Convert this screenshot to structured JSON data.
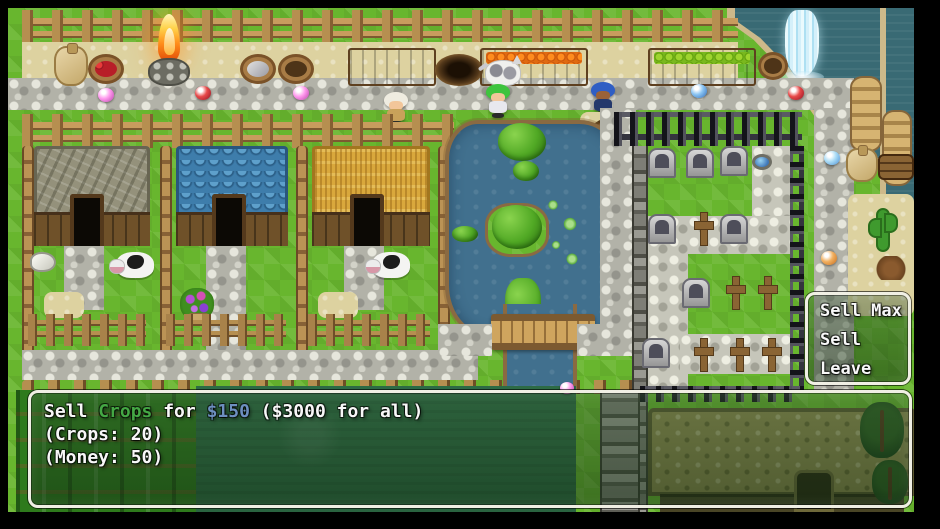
{
  "choice_window": {
    "items": [
      {
        "id": "sell-max",
        "label": "Sell Max"
      },
      {
        "id": "sell",
        "label": "Sell"
      },
      {
        "id": "leave",
        "label": "Leave"
      }
    ]
  },
  "dialog": {
    "line1_prefix": "Sell ",
    "line1_item": "Crops",
    "line1_mid": " for ",
    "line1_price": "$150",
    "line1_suffix": " ($3000 for all)",
    "line2": "(Crops: 20)",
    "line3": "(Money: 50)"
  },
  "colors": {
    "item_name_green": "#44a844",
    "price_blue": "#6d8fc0",
    "window_border": "#f0efe4",
    "text": "#f8f8f8",
    "grass": "#68b62e",
    "water": "#396a74",
    "pond": "#41708e"
  }
}
